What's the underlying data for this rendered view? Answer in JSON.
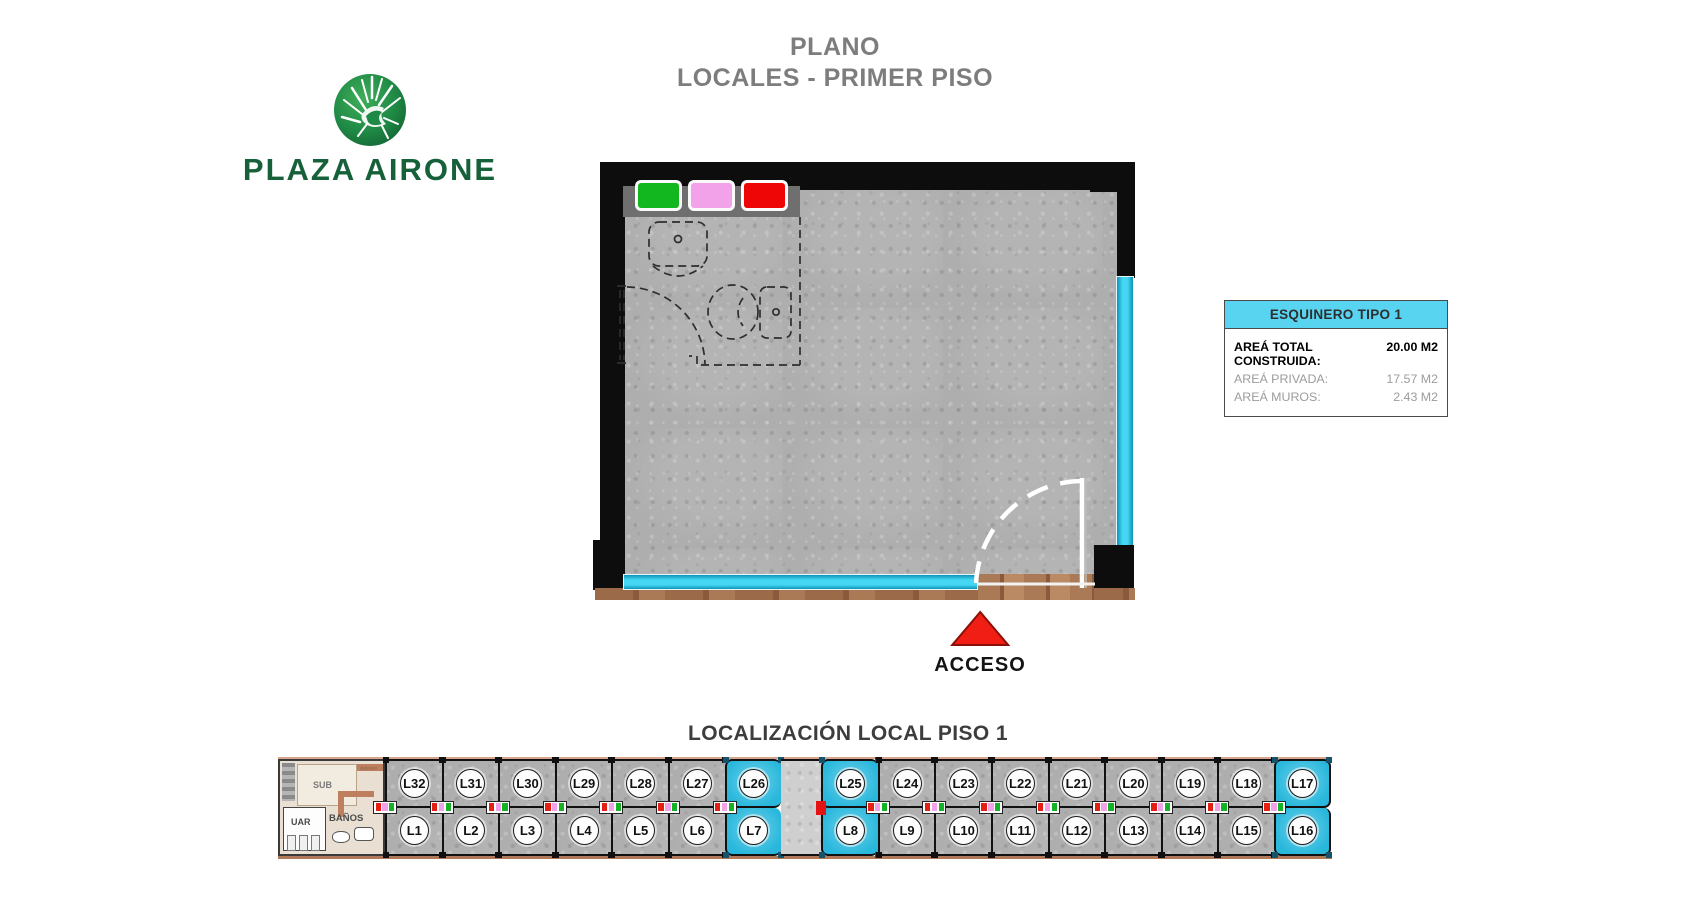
{
  "page": {
    "title_line1": "PLANO",
    "title_line2": "LOCALES - PRIMER PISO"
  },
  "logo": {
    "name": "PLAZA AIRONE"
  },
  "plan": {
    "access_label": "ACCESO",
    "swatch_colors": [
      "#12b71f",
      "#f2a2e8",
      "#ee0606"
    ],
    "accent_cyan": "#2fc6e8",
    "access_red": "#f01e15"
  },
  "info_box": {
    "header": "ESQUINERO TIPO 1",
    "header_color": "#58d3f0",
    "rows": [
      {
        "label": "AREÁ TOTAL CONSTRUIDA:",
        "value": "20.00 M2"
      },
      {
        "label": "AREÁ PRIVADA:",
        "value": "17.57 M2"
      },
      {
        "label": "AREÁ MUROS:",
        "value": "2.43 M2"
      }
    ]
  },
  "localization": {
    "title": "LOCALIZACIÓN LOCAL PISO 1",
    "highlight_color": "#29b8dc",
    "service_block": {
      "sub": "SUB",
      "banos": "BAÑOS",
      "uar": "UAR",
      "admin": "Admon"
    },
    "columns": [
      {
        "top": "L32",
        "bottom": "L1",
        "highlighted": false
      },
      {
        "top": "L31",
        "bottom": "L2",
        "highlighted": false
      },
      {
        "top": "L30",
        "bottom": "L3",
        "highlighted": false
      },
      {
        "top": "L29",
        "bottom": "L4",
        "highlighted": false
      },
      {
        "top": "L28",
        "bottom": "L5",
        "highlighted": false
      },
      {
        "top": "L27",
        "bottom": "L6",
        "highlighted": false
      },
      {
        "top": "L26",
        "bottom": "L7",
        "highlighted": true
      },
      {
        "gap": true
      },
      {
        "top": "L25",
        "bottom": "L8",
        "highlighted": true
      },
      {
        "top": "L24",
        "bottom": "L9",
        "highlighted": false
      },
      {
        "top": "L23",
        "bottom": "L10",
        "highlighted": false
      },
      {
        "top": "L22",
        "bottom": "L11",
        "highlighted": false
      },
      {
        "top": "L21",
        "bottom": "L12",
        "highlighted": false
      },
      {
        "top": "L20",
        "bottom": "L13",
        "highlighted": false
      },
      {
        "top": "L19",
        "bottom": "L14",
        "highlighted": false
      },
      {
        "top": "L18",
        "bottom": "L15",
        "highlighted": false
      },
      {
        "top": "L17",
        "bottom": "L16",
        "highlighted": true
      }
    ]
  }
}
